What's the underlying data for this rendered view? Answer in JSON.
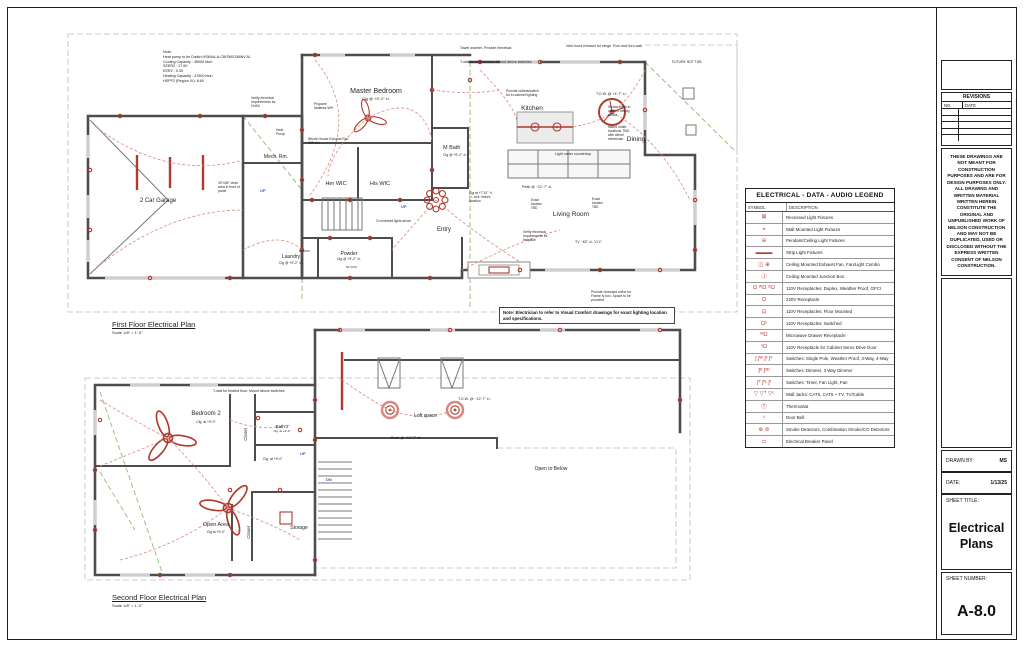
{
  "title_block": {
    "revisions_title": "REVISIONS",
    "revisions_no": "NO.",
    "revisions_date": "DATE",
    "disclaimer": "THESE DRAWINGS ARE NOT MEANT FOR CONSTRUCTION PURPOSES AND ARE FOR DESIGN PURPOSES ONLY. ALL DRAWING AND WRITTEN MATERIAL WRITTEN HEREIN CONSTITUTE THE ORIGINAL AND UNPUBLISHED WORK OF NELSON CONSTRUCTION AND MAY NOT BE DUPLICATED, USED OR DISCLOSED WITHOUT THE EXPRESS WRITTEN CONSENT OF NELSON CONSTRUCTION.",
    "drawn_by_label": "DRAWN BY:",
    "drawn_by_value": "MS",
    "date_label": "DATE:",
    "date_value": "1/13/25",
    "sheet_title_label": "SHEET TITLE:",
    "sheet_title_value": "Electrical\nPlans",
    "sheet_number_label": "SHEET NUMBER:",
    "sheet_number_value": "A-8.0"
  },
  "legend": {
    "title": "ELECTRICAL - DATA - AUDIO LEGEND",
    "symbol_header": "SYMBOL",
    "description_header": "DESCRIPTION",
    "rows": [
      {
        "name": "recessed-light",
        "glyph": "⊠",
        "desc": "Recessed Light Fixtures"
      },
      {
        "name": "wall-mounted-light",
        "glyph": "◒",
        "desc": "Wall Mounted Light Fixtures"
      },
      {
        "name": "pendant-ceiling-light",
        "glyph": "⊖",
        "desc": "Pendant/Ceiling Light Fixtures"
      },
      {
        "name": "strip-light",
        "glyph": "▬▬▬",
        "desc": "Strip Light Fixtures"
      },
      {
        "name": "ceiling-exhaust-fan",
        "glyph": "◫ ⊕",
        "desc": "Ceiling Mounted Exhaust Fan, Fan/Light Combo"
      },
      {
        "name": "junction-box",
        "glyph": "Ⓙ",
        "desc": "Ceiling Mounted Junction Box"
      },
      {
        "name": "receptacle-110",
        "glyph": "Ω ᵂΩ ᴳΩ",
        "desc": "110V Receptacles: Duplex, Weather Proof, GFCI"
      },
      {
        "name": "receptacle-220",
        "glyph": "Ω",
        "desc": "220V Receptacle"
      },
      {
        "name": "receptacle-floor",
        "glyph": "⊡",
        "desc": "110V Receptacles: Floor Mounted"
      },
      {
        "name": "receptacle-switched",
        "glyph": "Ωˢ",
        "desc": "110V Receptacles: Switched"
      },
      {
        "name": "microwave-receptacle",
        "glyph": "ᴹΩ",
        "desc": "Microwave Drawer Receptacle"
      },
      {
        "name": "cabinet-servo-receptacle",
        "glyph": "ˢΩ",
        "desc": "110V Receptacle for Cabinet Servo Drive Door"
      },
      {
        "name": "switches",
        "glyph": "ʃ ʃᵂ ʃ³ ʃ⁴",
        "desc": "Switches: Single Pole, Weather Proof, 3-Way, 4-Way"
      },
      {
        "name": "switches-dimmer",
        "glyph": "ʃᴰ ʃ³ᴰ",
        "desc": "Switches: Dimmer, 3 Way Dimmer"
      },
      {
        "name": "switches-timer-fan",
        "glyph": "ʃᵀ ʃᶠᴸ ʃᶠ",
        "desc": "Switches: Timer, Fan Light, Fan"
      },
      {
        "name": "wall-jacks",
        "glyph": "▽ ▽ᵀ ▽ᶜ",
        "desc": "Wall Jacks: CAT5, CAT5 + TV, TV/Cable"
      },
      {
        "name": "thermostat",
        "glyph": "Ⓣ",
        "desc": "Thermostat"
      },
      {
        "name": "door-bell",
        "glyph": "♀",
        "desc": "Door Bell"
      },
      {
        "name": "smoke-detector",
        "glyph": "⊛ ⊜",
        "desc": "Smoke Detectors, Combination Smoke/CO Detectors"
      },
      {
        "name": "breaker-panel",
        "glyph": "▭",
        "desc": "Electrical Breaker Panel"
      }
    ]
  },
  "notes": {
    "hvac_note": "Note:\nHeat pump to be Daikin HSMVA-A-CB/SMX348NVJU\nCooling Capacity : 45000 btuh\nSEER2 : 17.50\nEER2 : 9.35\nHeating Capacity : 47500 btuh\nHSPF2 (Region IV): 8.60",
    "electrician_note": "Note: Electrician to refer to Visual Comfort drawings for exact lighting location and specifications."
  },
  "first_floor": {
    "title": "First Floor Electrical Plan",
    "scale": "Scale 1/8\" = 1'-0\"",
    "labels": {
      "master_bedroom": "Master Bedroom",
      "master_clg": "Clg @ +9'-2\" ±/-",
      "kitchen": "Kitchen",
      "dining": "Dining",
      "living_room": "Living Room",
      "entry": "Entry",
      "garage": "2 Car Garage",
      "mech_rm": "Mech. Rm.",
      "her_wic": "Her WIC",
      "his_wic": "His WIC",
      "m_bath": "M Bath",
      "m_bath_clg": "Clg @ +9'-2\" ±/-",
      "laundry": "Laundry",
      "laundry_clg": "Clg @ +9'-2\" ±/-",
      "powder": "Powder",
      "powder_clg": "Clg @ +9'-2\" ±/-",
      "up_1": "UP",
      "up_2": "UP",
      "whole_house_fan": "Whole House Exhaust Fan\n300 cfm",
      "propane": "Propane\ntankless WH",
      "heat_pump": "Heat\nPump",
      "verify_hvac": "Verify electrical\nrequirements for\nHVAC",
      "panel_clear": "30\"x36\" clear\narea in front of\npanel",
      "towel_warmer": "Towel warmer. Provide electrical",
      "tstat_floor": "T-stat for heated floor. Mount above switches",
      "vent_hood": "Vent hood exhaust for range. Run duct thru wall.",
      "future_hot_tub": "FUTURE HOT TUB",
      "cabinet_lighting": "Provide outlets/switch\nfor in-cabinet lighting",
      "tow_kitchen": "T.O.W. @ +4'-7\" ±/-",
      "strobe_lights": "Strobe lights in\nvaulted ceiling\nabove",
      "island_outlets": "Island outlet\nlocations TBD\nwith client/\nelectrician",
      "under_counter": "Light under countertop",
      "clg_fixture": "Clg at +7'10\" +/-\n±/- at lt. fixture\nlocation",
      "peak": "Peak @ ~12'-7\" ±/-",
      "exact_tbd_1": "Exact\nlocation\nTBD",
      "exact_tbd_2": "Exact\nlocation\nTBD",
      "fireplace": "Verify electrical\nrequirements for\nfireplace",
      "tv": "TV ~62\" ±/- V.I.F.",
      "tv_niche": "Provide recessed niche for\nFrame tv box. Space to be\nprovided",
      "cfm_1": "50 CFM",
      "cfm_2": "50 CFM",
      "recessed_above": "To recessed lights above"
    }
  },
  "second_floor": {
    "title": "Second Floor Electrical Plan",
    "scale": "Scale 1/8\" = 1'-0\"",
    "labels": {
      "bedroom2": "Bedroom 2",
      "bedroom2_clg": "Clg. at +9'-0\"",
      "bath2": "Bath 2",
      "bath2_clg": "Clg. at +9'-0\"",
      "closet_1": "Closet",
      "closet_2": "Closet",
      "loft": "Loft space",
      "open_below": "Open to Below",
      "open_area": "Open Area",
      "open_area_clg": "Clg at +9'-0\"",
      "storage": "Storage",
      "hall_clg": "Clg. at +9'-0\"",
      "up": "UP",
      "dn": "DN",
      "tstat_floor": "T-stat for heated floor. Mount above switches",
      "tow_loft": "T.O.W. @ ~12'-7\" ±/-",
      "peak_loft": "Peak @ ~12'-7\" ±/-"
    }
  }
}
